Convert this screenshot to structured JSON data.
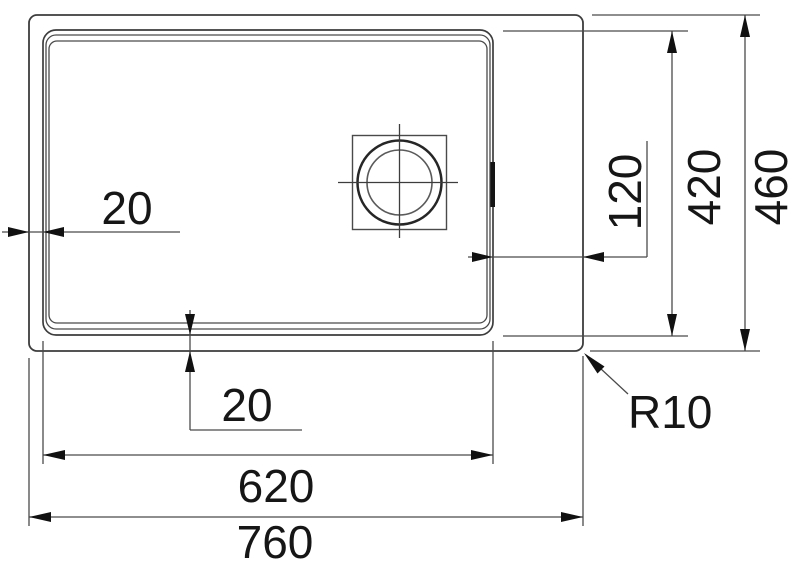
{
  "drawing": {
    "kind": "technical-dimension-drawing-top-view",
    "colors": {
      "background": "#ffffff",
      "object_line": "#3d3d3d",
      "dimension_line": "#4a4a4a",
      "text": "#161616",
      "arrow": "#111111"
    },
    "dims": {
      "left_offset": "20",
      "bottom_offset": "20",
      "right_ledge": "120",
      "bowl_depth": "420",
      "overall_depth": "460",
      "bowl_width": "620",
      "overall_width": "760",
      "corner_radius": "R10"
    }
  }
}
